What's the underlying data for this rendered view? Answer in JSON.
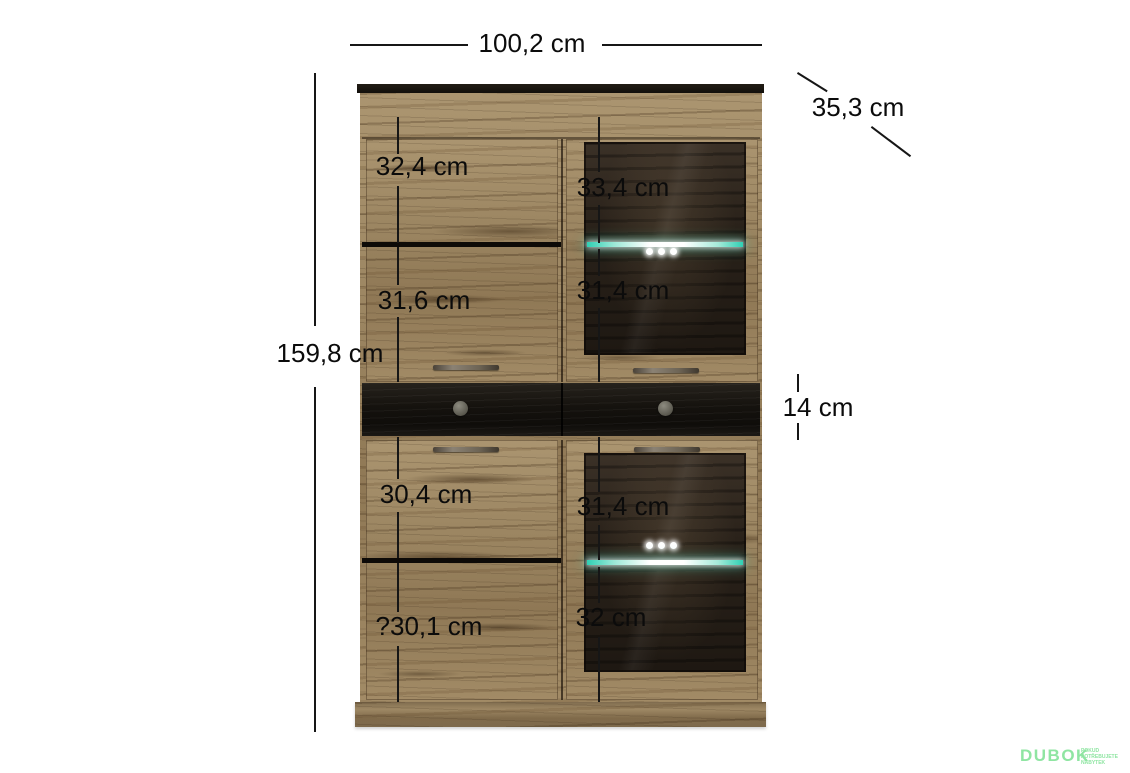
{
  "annotations": {
    "width": "100,2 cm",
    "depth": "35,3 cm",
    "height": "159,8 cm",
    "drawer": "14 cm",
    "left_column": [
      "32,4 cm",
      "31,6 cm",
      "30,4 cm",
      "?30,1 cm"
    ],
    "right_column": [
      "33,4 cm",
      "31,4 cm",
      "31,4 cm",
      "32 cm"
    ]
  },
  "watermark": {
    "brand": "DUBOK",
    "tagline": [
      "POKUD",
      "POTŘEBUJETE",
      "NÁBYTEK"
    ],
    "color": "#8fe5a2"
  },
  "colors": {
    "led_teal": "#2fd0b4",
    "wood_mid": "#9c8662",
    "dark_panel": "#17130e",
    "dimension_line": "#161616"
  }
}
